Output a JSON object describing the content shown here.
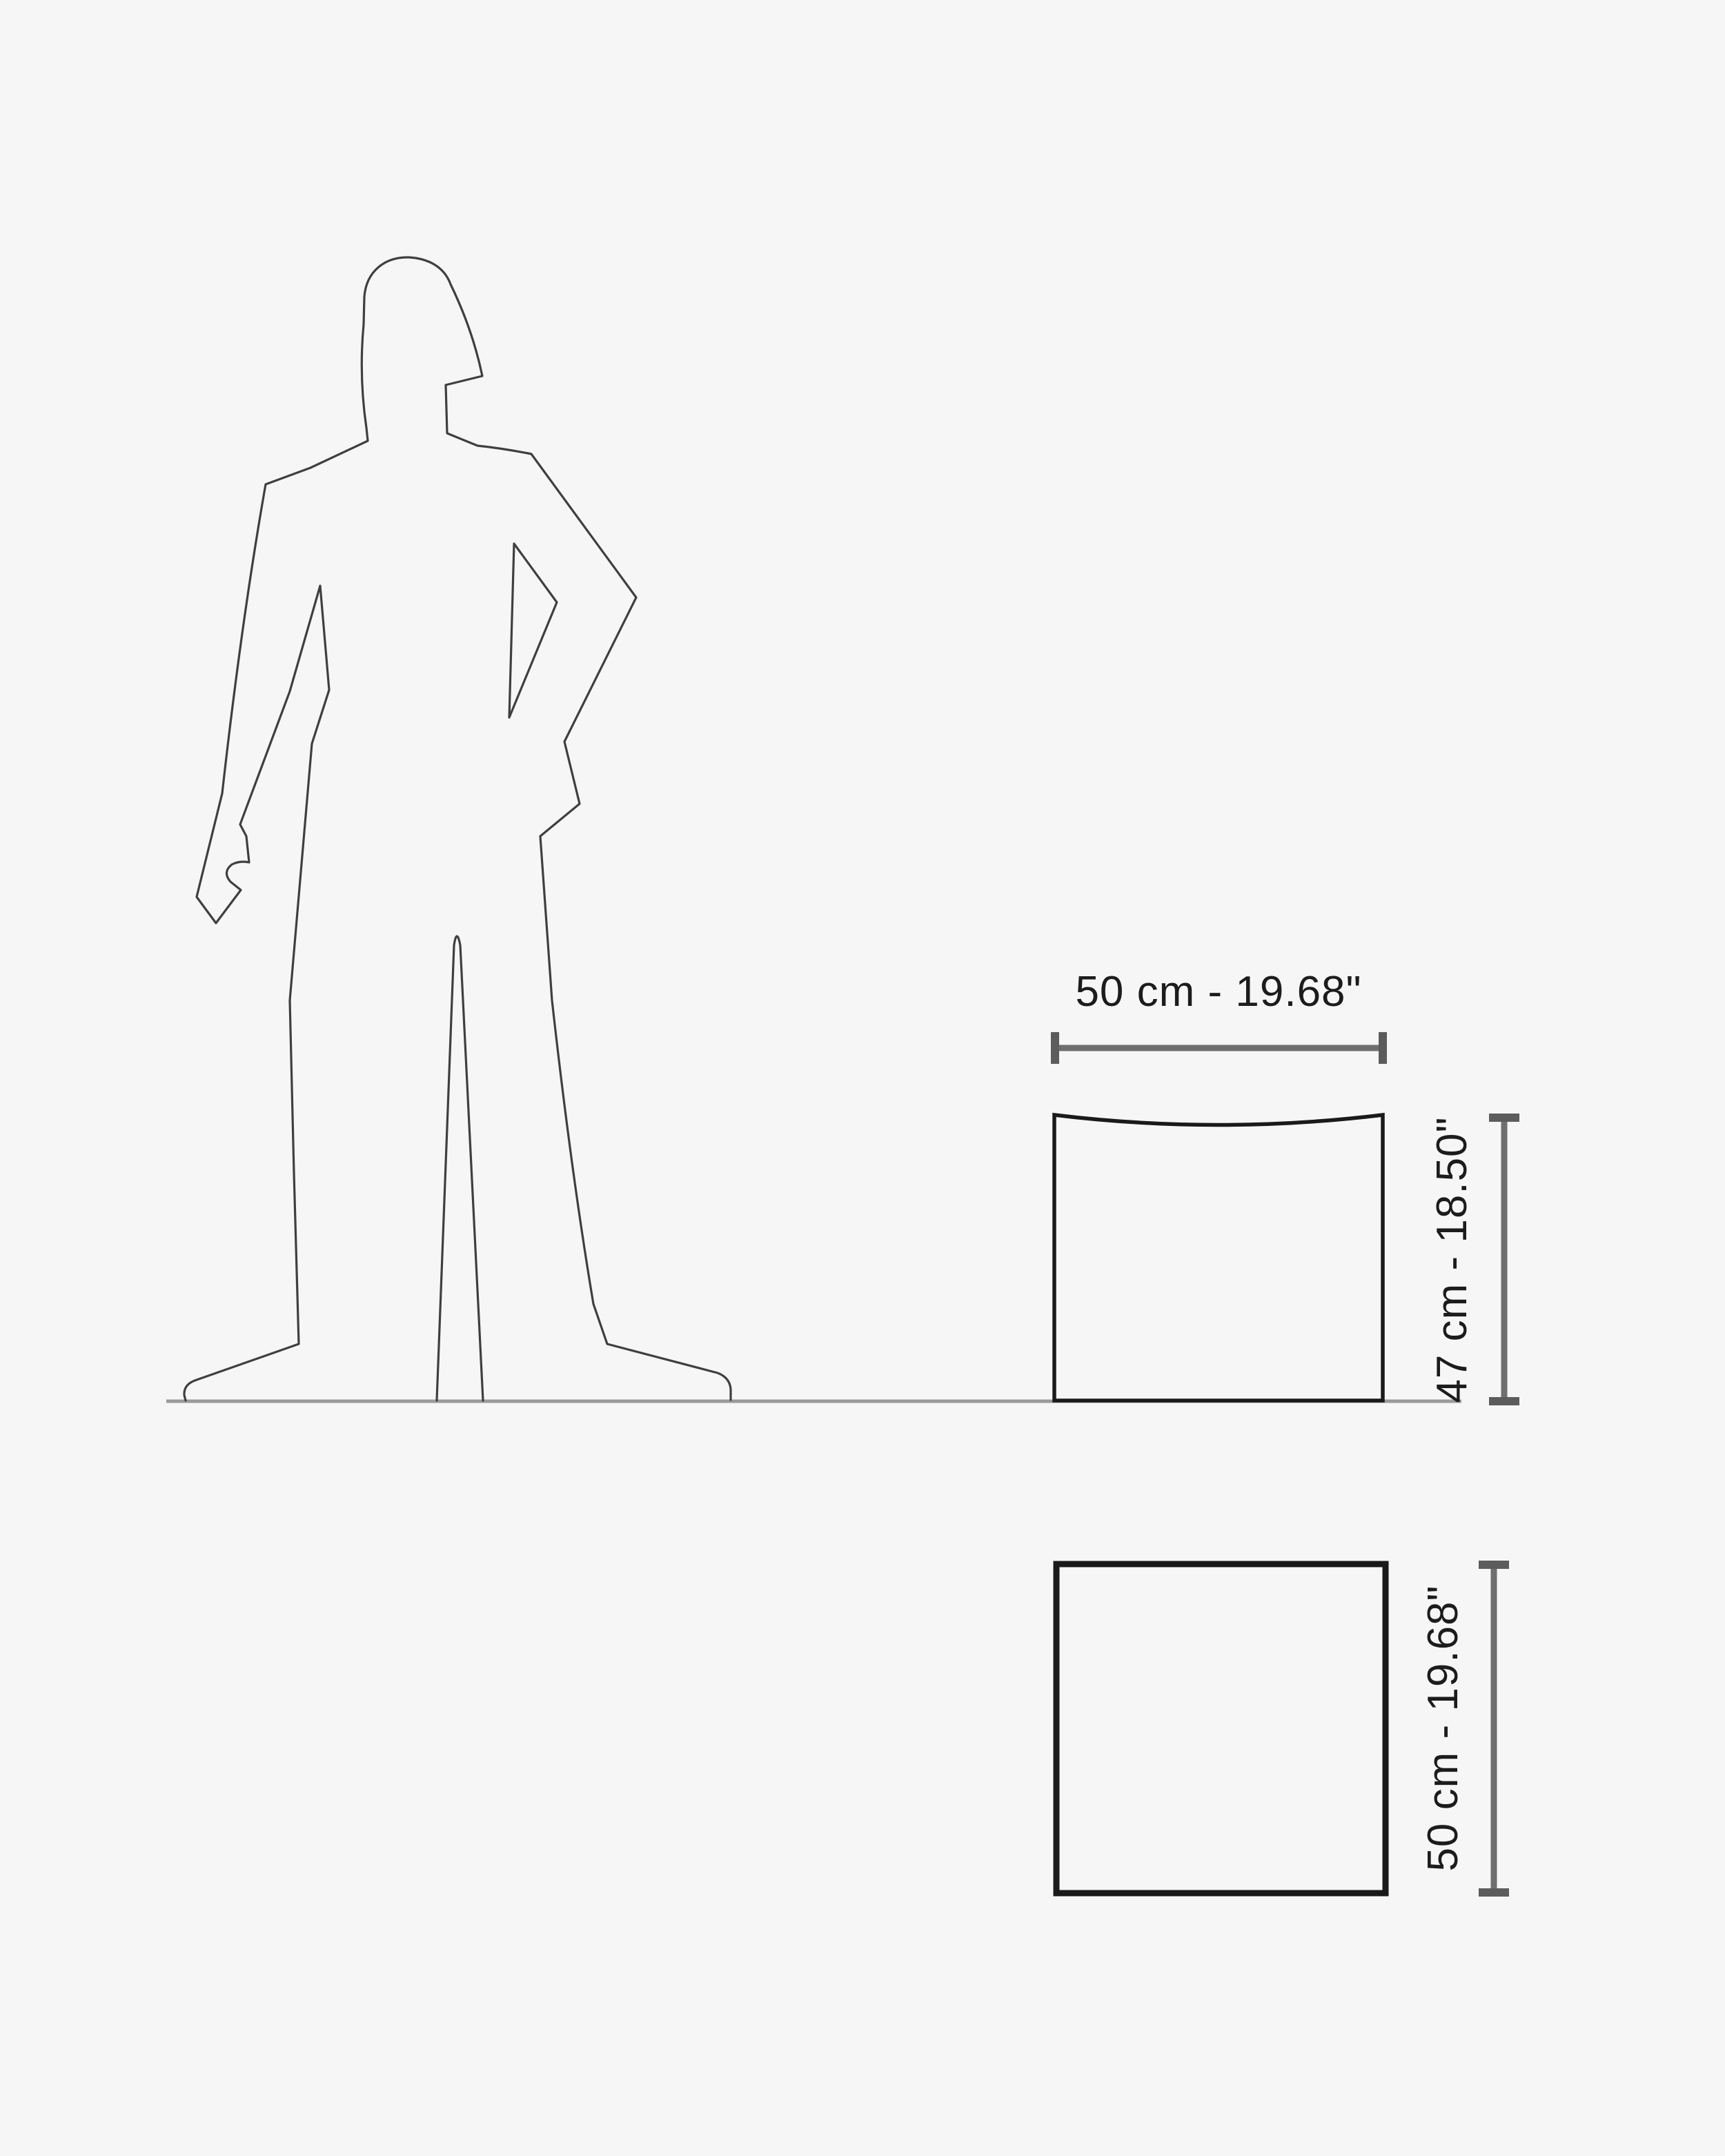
{
  "diagram": {
    "kind": "furniture-dimension-diagram",
    "views": [
      "front-elevation-with-human-scale",
      "top-plan"
    ]
  },
  "front_view": {
    "width_label": "50 cm - 19.68\"",
    "height_label": "47 cm - 18.50\""
  },
  "top_view": {
    "size_label": "50 cm - 19.68\""
  },
  "dimensions": {
    "width_cm": 50,
    "width_in": 19.68,
    "height_cm": 47,
    "height_in": 18.5,
    "depth_cm": 50,
    "depth_in": 19.68
  },
  "colors": {
    "background": "#f6f6f6",
    "figure_outline": "#3f3f3f",
    "furniture_outline": "#1a1a1a",
    "dimension_line": "#6f6f6f",
    "dimension_cap": "#5c5c5c",
    "ground_line": "#9a9a9a",
    "label_text": "#1c1c1c"
  }
}
